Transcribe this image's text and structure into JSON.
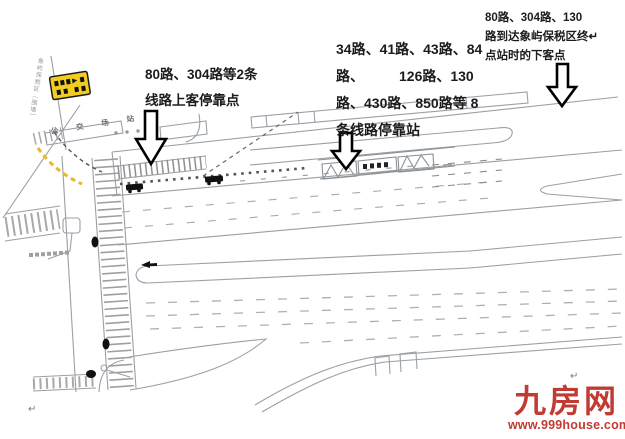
{
  "annotations": {
    "left": {
      "line1": "80路、304路等2条",
      "line2": "线路上客停靠点"
    },
    "middle": {
      "line1": "34路、41路、43路、84",
      "line2": "路、         126路、130",
      "line3": "路、430路、850路等 8",
      "line4": "条线路停靠站"
    },
    "top_right": {
      "line1": "80路、304路、130",
      "line2": "路到达象屿保税区终↵",
      "line3": "点站时的下客点"
    }
  },
  "map": {
    "station_area_label": "公 交 场 站",
    "boundary_label": "象屿保税区（围墙）",
    "return_mark": "↵",
    "colors": {
      "road_line": "#9aa0a6",
      "accent_yellow": "#f2cc1f",
      "watermark_red": "#c13b33"
    }
  },
  "watermark": {
    "logo": "九房网",
    "url": "www.999house.com"
  }
}
